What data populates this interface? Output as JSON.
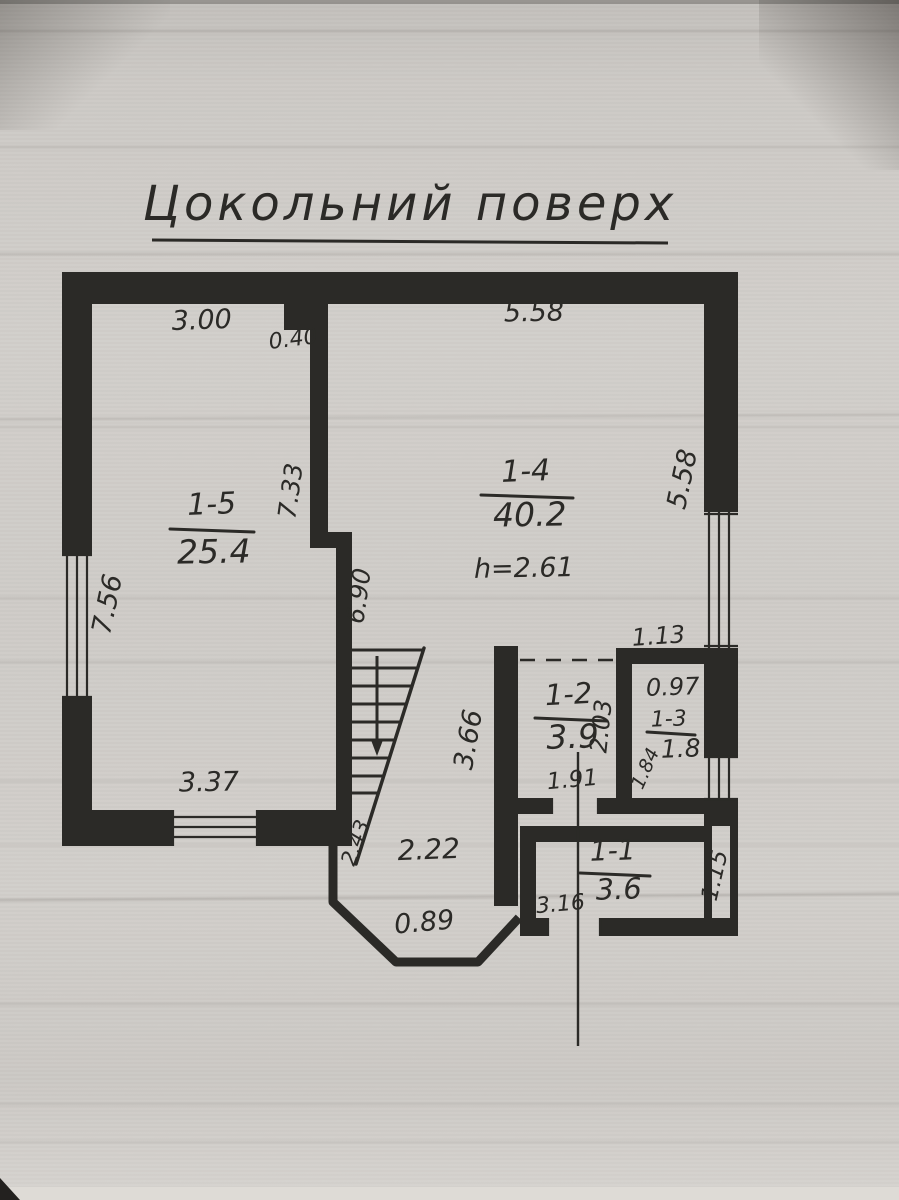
{
  "photo": {
    "paper_color": "#cdcac8",
    "ink_color": "#2b2a27"
  },
  "title": {
    "text": "Цокольний поверх"
  },
  "rooms": {
    "r15": {
      "id": "1-5",
      "area": "25.4"
    },
    "r14": {
      "id": "1-4",
      "area": "40.2",
      "height": "h=2.61"
    },
    "r12": {
      "id": "1-2",
      "area": "3.9"
    },
    "r13": {
      "id": "1-3",
      "area": "1.8"
    },
    "r11": {
      "id": "1-1",
      "area": "3.6"
    }
  },
  "dims": {
    "d300": "3.00",
    "d040": "0.40",
    "d558top": "5.58",
    "d756": "7.56",
    "d733": "7.33",
    "d690": "6.90",
    "d558right": "5.58",
    "d113": "1.13",
    "d097": "0.97",
    "d203": "2.03",
    "d184": "1.84",
    "d191": "1.91",
    "d366": "3.66",
    "d337": "3.37",
    "d222": "2.22",
    "d089": "0.89",
    "d243": "2.43",
    "d316": "3.16",
    "d115": "1.15"
  }
}
